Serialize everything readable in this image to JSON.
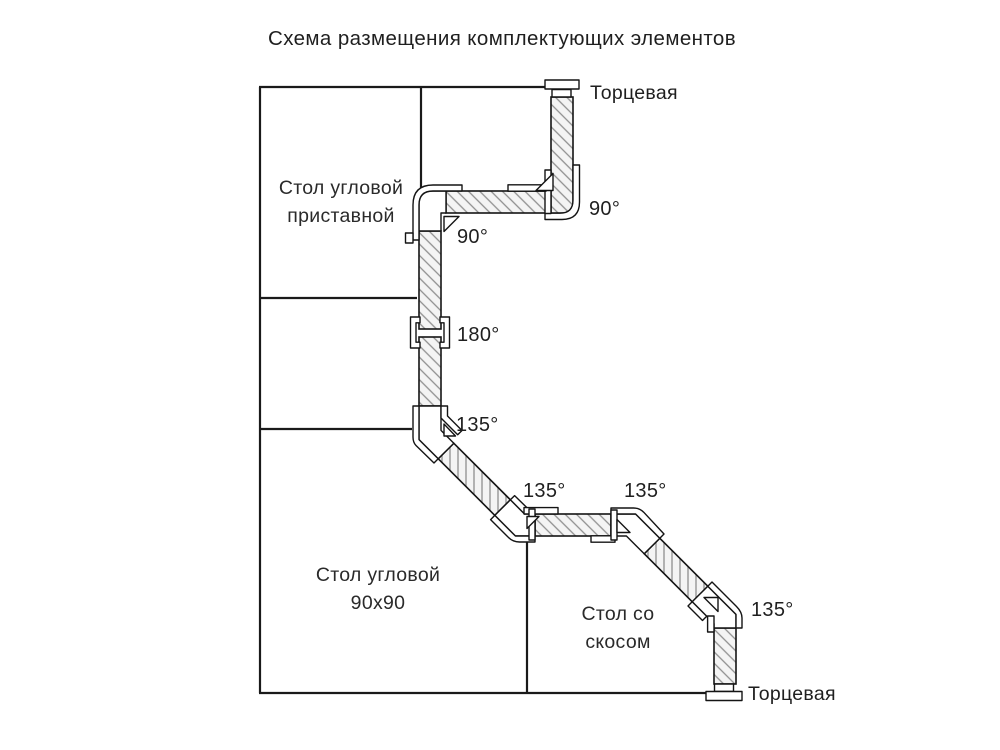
{
  "title": "Схема размещения комплектующих элементов",
  "tables": {
    "corner_attached": {
      "line1": "Стол угловой",
      "line2": "приставной"
    },
    "corner_90x90": {
      "line1": "Стол угловой",
      "line2": "90х90"
    },
    "beveled": {
      "line1": "Стол со",
      "line2": "скосом"
    }
  },
  "caps": {
    "top": "Торцевая",
    "bottom": "Торцевая"
  },
  "angles": {
    "a90_top_right": "90°",
    "a90_inner": "90°",
    "a180": "180°",
    "a135_bend1": "135°",
    "a135_left": "135°",
    "a135_right": "135°",
    "a135_bottom": "135°"
  },
  "colors": {
    "outline": "#1a1a1a",
    "strip_fill": "#f4f4f4",
    "hatch_line": "#8f8f8f",
    "connector_fill": "#ffffff",
    "background": "#ffffff"
  }
}
